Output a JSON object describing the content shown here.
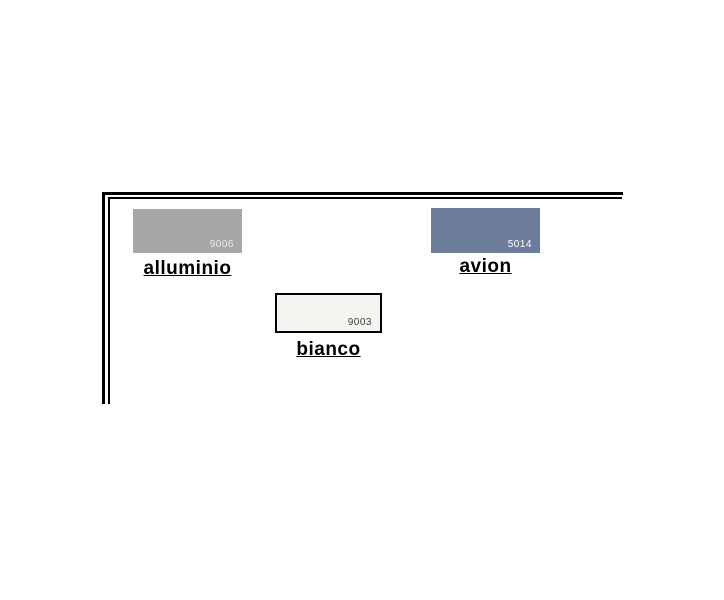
{
  "page": {
    "background": "#ffffff"
  },
  "frame": {
    "border_color": "#000000"
  },
  "swatches": [
    {
      "id": "alluminio",
      "label": "alluminio",
      "code": "9006",
      "color": "#a7a7a5",
      "code_color": "#e9e9e7"
    },
    {
      "id": "avion",
      "label": "avion",
      "code": "5014",
      "color": "#6d7c9b",
      "code_color": "#ffffff"
    },
    {
      "id": "bianco",
      "label": "bianco",
      "code": "9003",
      "color": "#f2f5f0",
      "code_color": "#3f3f3f",
      "border_color": "#000000"
    }
  ]
}
